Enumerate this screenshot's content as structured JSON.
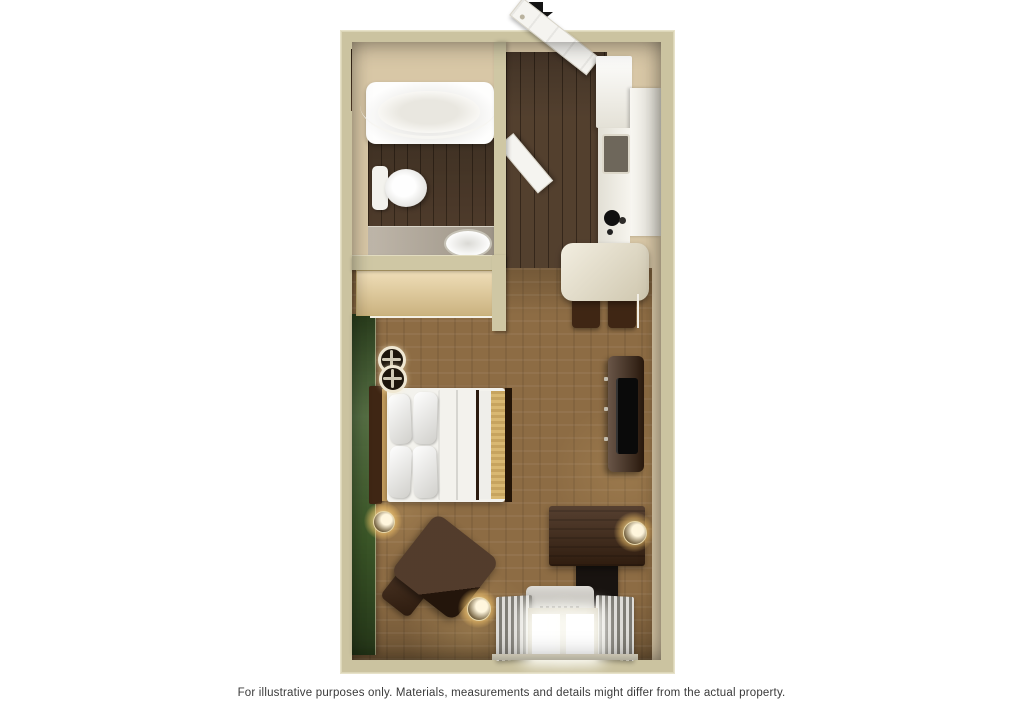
{
  "image": {
    "type": "3d-floor-plan-rendering",
    "background": "#ffffff"
  },
  "arrow": {
    "icon": "arrow-down-icon",
    "meaning": "unit entrance direction",
    "color": "#141414"
  },
  "caption": {
    "text": "For illustrative purposes only.  Materials, measurements and details might differ from the actual property.",
    "color": "#3a3a3a"
  },
  "floorplan": {
    "rooms": [
      {
        "name": "bathroom",
        "floor": "dark-wood",
        "fixtures": [
          "bathtub",
          "curved-shower-rod",
          "toilet",
          "vanity-counter",
          "sink",
          "wall-niche"
        ]
      },
      {
        "name": "closet",
        "fixtures": [
          "shelf-counter",
          "hanging-rod-with-hangers"
        ]
      },
      {
        "name": "entry-hall",
        "floor": "dark-wood",
        "fixtures": [
          "entry-door-open",
          "bathroom-door-open"
        ]
      },
      {
        "name": "kitchen",
        "fixtures": [
          "refrigerator",
          "upper-cabinets",
          "microwave",
          "stove-cooktop",
          "counter-table",
          "two-stools"
        ]
      },
      {
        "name": "studio-main-room",
        "floor": "carpet",
        "fixtures": [
          "green-accent-wall",
          "bed-with-pillows",
          "two-ceiling-lights",
          "tv-stand",
          "flat-tv",
          "desk",
          "desk-chair",
          "armchair",
          "ottoman",
          "three-wall-sconces",
          "air-conditioner",
          "window-with-curtains"
        ]
      }
    ],
    "colors": {
      "wall": "#cbc3a0",
      "wall_face": "#d8c7a6",
      "wood_floor": "#4c3826",
      "carpet": "#8d6c44",
      "accent_wall_green": "#3f5c2b",
      "fixture_white": "#f3f2ed",
      "vanity_gray": "#b3a99a",
      "counter_tan": "#e7cc92",
      "cabinet_white": "#f0ede2",
      "table_cream": "#e6ddc2",
      "furniture_dark": "#3f2614",
      "tv_black": "#0a0a0a",
      "door_white": "#f5f4f0",
      "curtain_gray": "#b5b1a8",
      "ac_gray": "#b7b2a8",
      "sconce_glow": "#ffd98e"
    }
  }
}
